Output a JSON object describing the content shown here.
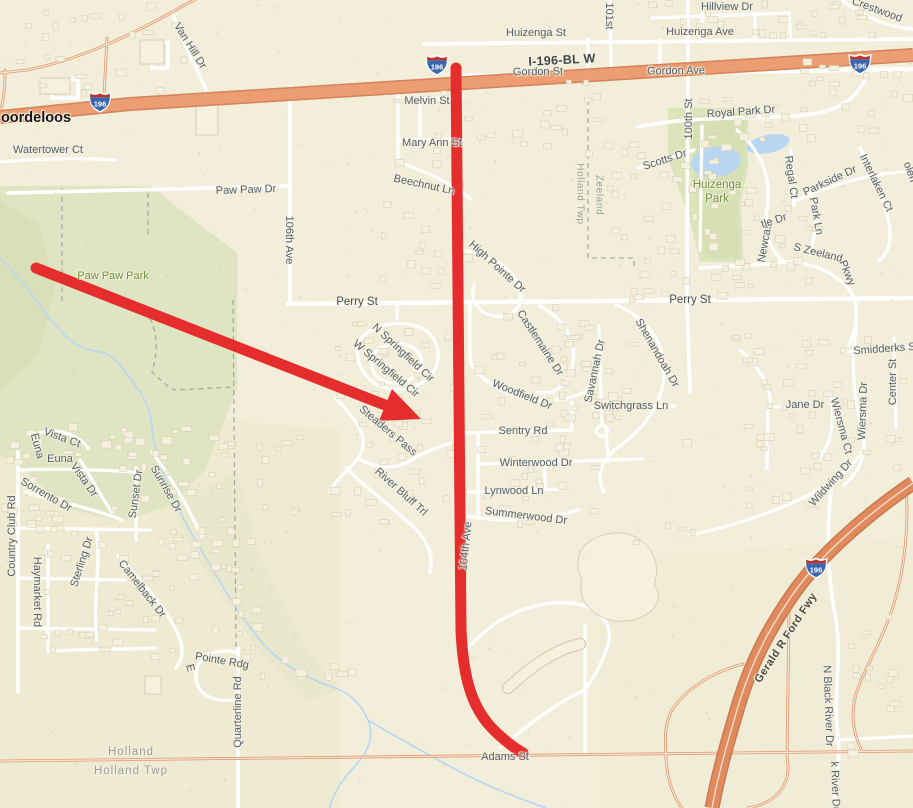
{
  "map": {
    "description": "Street map of Holland Twp / Zeeland area with red route annotation along 104th Ave and red arrow pointing to Springfield subdivision",
    "colors": {
      "background": "#f2eeda",
      "park_green": "#dfe4c2",
      "water_blue": "#b8d6f2",
      "highway_fill": "#ec9e72",
      "highway_casing": "#d3825c",
      "freeway_fill": "#e18a5e",
      "freeway_casing": "#c97950",
      "minor_highway": "#e2966f",
      "road_white": "#ffffff",
      "road_casing": "#c8c3ab",
      "annotation_red": "#e62d2d",
      "building_fill": "#f6f1de",
      "building_stroke": "#d6cfb4",
      "shield_blue": "#3a66ad",
      "shield_red": "#bb342c"
    },
    "shield": {
      "route": "196",
      "positions": [
        {
          "x": 100,
          "y": 102
        },
        {
          "x": 437,
          "y": 65
        },
        {
          "x": 860,
          "y": 64
        },
        {
          "x": 816,
          "y": 568
        }
      ]
    },
    "annotations": {
      "route_line": "vertical red line along 104th Ave from I-196-BL W down to Adams St",
      "arrow": "red arrow from Paw Paw Park pointing southeast into W Springfield Cir subdivision"
    },
    "labels": [
      {
        "text": "Hillview Dr",
        "x": 727,
        "y": 7,
        "r": 0,
        "cls": "st"
      },
      {
        "text": "Crestwood",
        "x": 877,
        "y": 10,
        "r": 20,
        "cls": "st"
      },
      {
        "text": "Huizenga St",
        "x": 536,
        "y": 33,
        "r": 0,
        "cls": "st"
      },
      {
        "text": "Huizenga Ave",
        "x": 700,
        "y": 32,
        "r": 0,
        "cls": "st"
      },
      {
        "text": "101st",
        "x": 609,
        "y": 16,
        "r": 90,
        "cls": "st"
      },
      {
        "text": "I-196-BL W",
        "x": 562,
        "y": 60,
        "r": -3,
        "cls": "hw"
      },
      {
        "text": "Gordon St",
        "x": 538,
        "y": 72,
        "r": -1,
        "cls": "st"
      },
      {
        "text": "Gordon Ave",
        "x": 676,
        "y": 71,
        "r": -1,
        "cls": "st"
      },
      {
        "text": "oordeloos",
        "x": 36,
        "y": 118,
        "r": 0,
        "cls": "place"
      },
      {
        "text": "Watertower Ct",
        "x": 48,
        "y": 150,
        "r": 0,
        "cls": "st"
      },
      {
        "text": "Van Hill Dr",
        "x": 190,
        "y": 46,
        "r": 58,
        "cls": "st"
      },
      {
        "text": "Paw Paw Dr",
        "x": 246,
        "y": 190,
        "r": -2,
        "cls": "st"
      },
      {
        "text": "Melvin St",
        "x": 427,
        "y": 101,
        "r": 0,
        "cls": "st"
      },
      {
        "text": "Mary Ann St",
        "x": 432,
        "y": 143,
        "r": 0,
        "cls": "st"
      },
      {
        "text": "Beechnut Ln",
        "x": 424,
        "y": 185,
        "r": 12,
        "cls": "st"
      },
      {
        "text": "106th Ave",
        "x": 289,
        "y": 240,
        "r": 90,
        "cls": "st"
      },
      {
        "text": "High Pointe Dr",
        "x": 497,
        "y": 267,
        "r": 42,
        "cls": "st"
      },
      {
        "text": "Perry St",
        "x": 357,
        "y": 302,
        "r": 0,
        "cls": "mj"
      },
      {
        "text": "Perry St",
        "x": 690,
        "y": 300,
        "r": 0,
        "cls": "mj"
      },
      {
        "text": "Royal Park Dr",
        "x": 741,
        "y": 112,
        "r": -4,
        "cls": "st"
      },
      {
        "text": "100th St",
        "x": 689,
        "y": 119,
        "r": -90,
        "cls": "st"
      },
      {
        "text": "Scotts Dr",
        "x": 665,
        "y": 160,
        "r": -18,
        "cls": "st"
      },
      {
        "text": "Huizenga",
        "x": 717,
        "y": 185,
        "r": 0,
        "cls": "parkBig"
      },
      {
        "text": "Park",
        "x": 717,
        "y": 199,
        "r": 0,
        "cls": "parkBig"
      },
      {
        "text": "Holland Twp",
        "x": 580,
        "y": 194,
        "r": 90,
        "cls": "areaV"
      },
      {
        "text": "Zeeland",
        "x": 599,
        "y": 195,
        "r": 90,
        "cls": "areaV"
      },
      {
        "text": "Regal Ct",
        "x": 791,
        "y": 177,
        "r": 82,
        "cls": "st"
      },
      {
        "text": "Parkside Dr",
        "x": 830,
        "y": 181,
        "r": -25,
        "cls": "st"
      },
      {
        "text": "Interlaken Ct",
        "x": 876,
        "y": 183,
        "r": 64,
        "cls": "st"
      },
      {
        "text": "olen",
        "x": 910,
        "y": 172,
        "r": 70,
        "cls": "st"
      },
      {
        "text": "Newcas",
        "x": 765,
        "y": 243,
        "r": -80,
        "cls": "st"
      },
      {
        "text": "tle Dr",
        "x": 774,
        "y": 221,
        "r": -18,
        "cls": "st"
      },
      {
        "text": "Park Ln",
        "x": 816,
        "y": 216,
        "r": 80,
        "cls": "st"
      },
      {
        "text": "S Zeeland",
        "x": 818,
        "y": 253,
        "r": 14,
        "cls": "st"
      },
      {
        "text": "Pkwy",
        "x": 847,
        "y": 273,
        "r": 68,
        "cls": "st"
      },
      {
        "text": "Smidderks St",
        "x": 886,
        "y": 349,
        "r": -4,
        "cls": "st"
      },
      {
        "text": "Center St",
        "x": 893,
        "y": 382,
        "r": -90,
        "cls": "st"
      },
      {
        "text": "Wiersma Dr",
        "x": 863,
        "y": 411,
        "r": -88,
        "cls": "st"
      },
      {
        "text": "Wiersma Ct",
        "x": 841,
        "y": 426,
        "r": 75,
        "cls": "st"
      },
      {
        "text": "Jane Dr",
        "x": 805,
        "y": 405,
        "r": 0,
        "cls": "st"
      },
      {
        "text": "Wildwing Dr",
        "x": 831,
        "y": 483,
        "r": -48,
        "cls": "st"
      },
      {
        "text": "N Springfield Cir",
        "x": 403,
        "y": 353,
        "r": 43,
        "cls": "st"
      },
      {
        "text": "W Springfield Cir",
        "x": 386,
        "y": 369,
        "r": 40,
        "cls": "st"
      },
      {
        "text": "Steaders Pass",
        "x": 388,
        "y": 431,
        "r": 40,
        "cls": "st"
      },
      {
        "text": "River Bluff Trl",
        "x": 401,
        "y": 492,
        "r": 42,
        "cls": "st"
      },
      {
        "text": "Castlemaine Dr",
        "x": 540,
        "y": 343,
        "r": 57,
        "cls": "st"
      },
      {
        "text": "Savannah Dr",
        "x": 595,
        "y": 371,
        "r": -78,
        "cls": "st"
      },
      {
        "text": "Switchgrass Ln",
        "x": 631,
        "y": 406,
        "r": 0,
        "cls": "st"
      },
      {
        "text": "Shenandoah Dr",
        "x": 657,
        "y": 353,
        "r": 60,
        "cls": "st"
      },
      {
        "text": "Woodfield Dr",
        "x": 522,
        "y": 395,
        "r": 22,
        "cls": "st"
      },
      {
        "text": "Sentry Rd",
        "x": 523,
        "y": 431,
        "r": 0,
        "cls": "st"
      },
      {
        "text": "Winterwood Dr",
        "x": 536,
        "y": 463,
        "r": 0,
        "cls": "st"
      },
      {
        "text": "Lynwood Ln",
        "x": 514,
        "y": 491,
        "r": 0,
        "cls": "st"
      },
      {
        "text": "Summerwood Dr",
        "x": 526,
        "y": 516,
        "r": 7,
        "cls": "st"
      },
      {
        "text": "104th Ave",
        "x": 466,
        "y": 546,
        "r": -84,
        "cls": "st"
      },
      {
        "text": "Euna",
        "x": 37,
        "y": 446,
        "r": 75,
        "cls": "st"
      },
      {
        "text": "Vista Ct",
        "x": 62,
        "y": 438,
        "r": 20,
        "cls": "st"
      },
      {
        "text": "Euna",
        "x": 60,
        "y": 459,
        "r": 0,
        "cls": "st"
      },
      {
        "text": "Vista Dr",
        "x": 84,
        "y": 480,
        "r": 55,
        "cls": "st"
      },
      {
        "text": "Sorrento Dr",
        "x": 46,
        "y": 495,
        "r": 30,
        "cls": "st"
      },
      {
        "text": "Country Club Rd",
        "x": 12,
        "y": 536,
        "r": -90,
        "cls": "st"
      },
      {
        "text": "Sunset Dr",
        "x": 136,
        "y": 494,
        "r": -82,
        "cls": "st"
      },
      {
        "text": "Sunrise Dr",
        "x": 166,
        "y": 489,
        "r": 60,
        "cls": "st"
      },
      {
        "text": "Sterling Dr",
        "x": 82,
        "y": 562,
        "r": -72,
        "cls": "st"
      },
      {
        "text": "Camelback Dr",
        "x": 142,
        "y": 589,
        "r": 52,
        "cls": "st"
      },
      {
        "text": "Haymarket Rd",
        "x": 37,
        "y": 592,
        "r": 90,
        "cls": "st"
      },
      {
        "text": "E",
        "x": 190,
        "y": 668,
        "r": 75,
        "cls": "st"
      },
      {
        "text": "Pointe Rdg",
        "x": 222,
        "y": 661,
        "r": 10,
        "cls": "st"
      },
      {
        "text": "Quarterline Rd",
        "x": 238,
        "y": 712,
        "r": -90,
        "cls": "st"
      },
      {
        "text": "Holland",
        "x": 131,
        "y": 752,
        "r": 0,
        "cls": "area"
      },
      {
        "text": "Holland Twp",
        "x": 131,
        "y": 771,
        "r": 0,
        "cls": "area"
      },
      {
        "text": "Adams St",
        "x": 505,
        "y": 757,
        "r": 0,
        "cls": "st"
      },
      {
        "text": "Gerald R Ford Fwy",
        "x": 786,
        "y": 638,
        "r": -57,
        "cls": "fwy"
      },
      {
        "text": "N Black River Dr",
        "x": 828,
        "y": 706,
        "r": 88,
        "cls": "st"
      },
      {
        "text": "k River Dr",
        "x": 835,
        "y": 786,
        "r": 88,
        "cls": "st"
      },
      {
        "text": "Paw Paw Park",
        "x": 113,
        "y": 276,
        "r": 0,
        "cls": "park"
      }
    ]
  }
}
